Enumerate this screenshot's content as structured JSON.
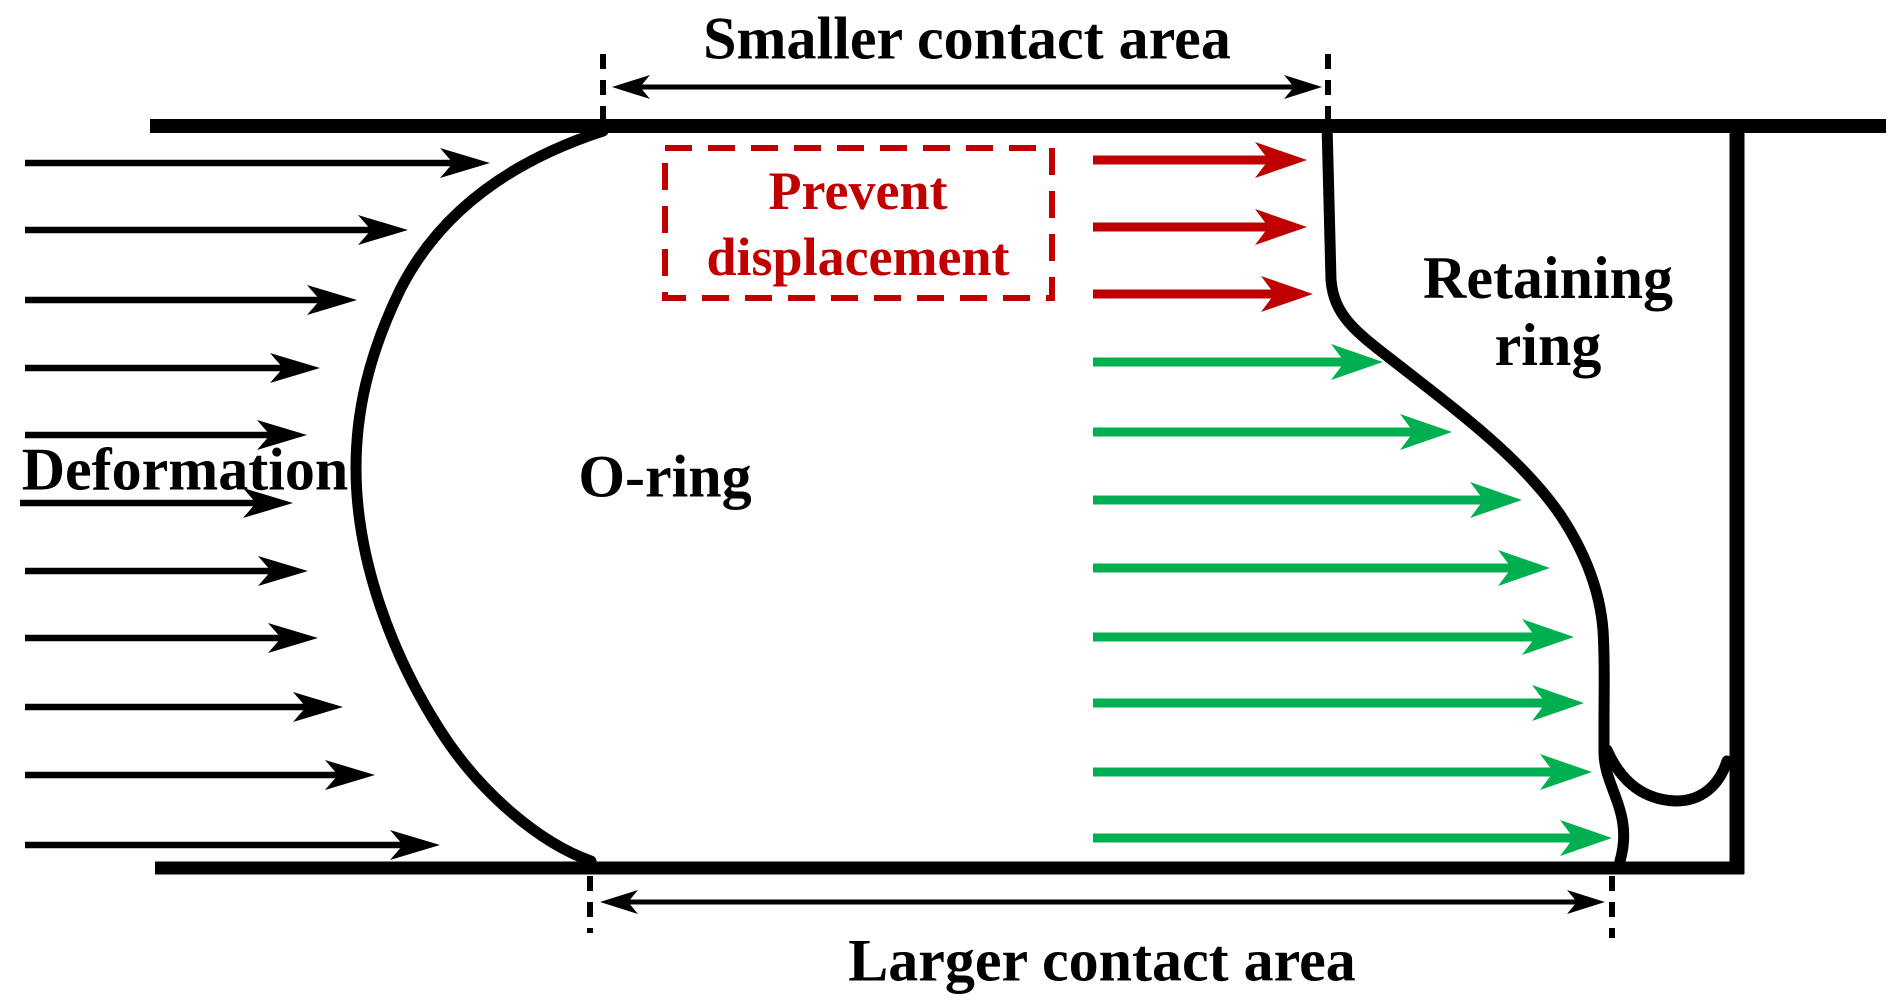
{
  "labels": {
    "smaller_contact_area": "Smaller contact area",
    "larger_contact_area": "Larger contact area",
    "deformation": "Deformation",
    "o_ring": "O-ring",
    "retaining_ring": {
      "line1": "Retaining",
      "line2": "ring"
    },
    "prevent_displacement": {
      "line1": "Prevent",
      "line2": "displacement"
    }
  },
  "colors": {
    "outline": "#000000",
    "prevent_red": "#C00000",
    "pressure_green": "#00B050",
    "background": "#ffffff"
  },
  "arrows": {
    "deformation_black": [
      {
        "y": 163,
        "x1": 25,
        "x2": 490
      },
      {
        "y": 230,
        "x1": 25,
        "x2": 408
      },
      {
        "y": 300,
        "x1": 25,
        "x2": 357
      },
      {
        "y": 368,
        "x1": 25,
        "x2": 320
      },
      {
        "y": 435,
        "x1": 25,
        "x2": 307
      },
      {
        "y": 503,
        "x1": 20,
        "x2": 293
      },
      {
        "y": 571,
        "x1": 25,
        "x2": 308
      },
      {
        "y": 638,
        "x1": 25,
        "x2": 318
      },
      {
        "y": 707,
        "x1": 25,
        "x2": 343
      },
      {
        "y": 775,
        "x1": 25,
        "x2": 375
      },
      {
        "y": 845,
        "x1": 25,
        "x2": 440
      }
    ],
    "prevent_red": [
      {
        "y": 160,
        "x1": 1093,
        "x2": 1307
      },
      {
        "y": 227,
        "x1": 1093,
        "x2": 1307
      },
      {
        "y": 294,
        "x1": 1093,
        "x2": 1313
      }
    ],
    "pressure_green": [
      {
        "y": 362,
        "x1": 1093,
        "x2": 1383
      },
      {
        "y": 432,
        "x1": 1093,
        "x2": 1452
      },
      {
        "y": 500,
        "x1": 1093,
        "x2": 1522
      },
      {
        "y": 568,
        "x1": 1093,
        "x2": 1550
      },
      {
        "y": 637,
        "x1": 1093,
        "x2": 1574
      },
      {
        "y": 703,
        "x1": 1093,
        "x2": 1584
      },
      {
        "y": 772,
        "x1": 1093,
        "x2": 1592
      },
      {
        "y": 838,
        "x1": 1093,
        "x2": 1612
      }
    ]
  },
  "dimensions": {
    "smaller": {
      "y": 87,
      "x1": 612,
      "x2": 1322
    },
    "larger": {
      "y": 902,
      "x1": 600,
      "x2": 1605
    }
  },
  "guides": [
    {
      "x": 603,
      "y1": 54,
      "y2": 120
    },
    {
      "x": 1328,
      "y1": 54,
      "y2": 120
    },
    {
      "x": 590,
      "y1": 876,
      "y2": 933
    },
    {
      "x": 1612,
      "y1": 876,
      "y2": 938
    }
  ]
}
